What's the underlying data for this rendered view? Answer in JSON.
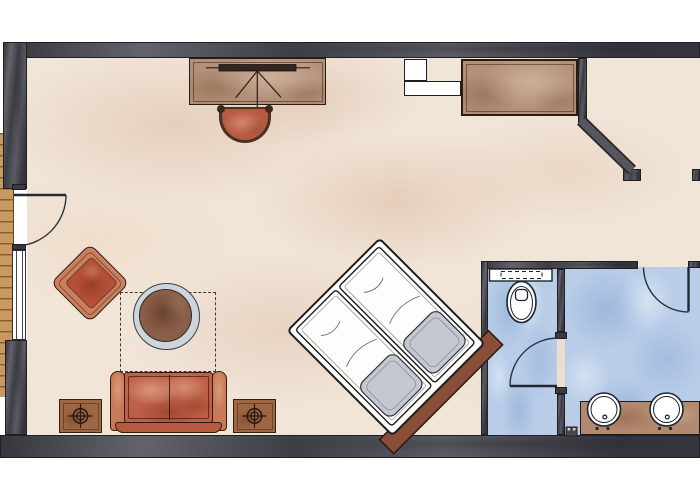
{
  "meta": {
    "kind": "hotel-room-floor-plan",
    "style": "hand-drawn-watercolor",
    "visible_text": []
  },
  "palette": {
    "background": "#ffffff",
    "wall": "#4d4d56",
    "wall_dark": "#33333b",
    "floor_beige": "#f1e5d8",
    "floor_blue": "#b9cde8",
    "wood_deck": "#c9995f",
    "furniture_brown": "#b3907a",
    "rust_red": "#bc6047",
    "rust_dark": "#9a4630",
    "outline": "#2a1c12",
    "bed_white": "#fdfdfc",
    "pillow_gray": "#c4c8d0",
    "headboard": "#8a4e38",
    "fixture_white": "#ffffff",
    "line_dark": "#1c2430",
    "counter": "#b28a70",
    "table_ring": "#ccd4dc",
    "table_top": "#8a5f4a",
    "tv_bar": "#332620"
  },
  "rooms": {
    "bedroom": {
      "floor": "beige-watercolor"
    },
    "entry": {
      "floor": "beige-watercolor"
    },
    "wc": {
      "floor": "blue-watercolor",
      "fixtures": [
        "toilet"
      ],
      "doors": 1
    },
    "bathroom": {
      "floor": "blue-watercolor",
      "fixtures": [
        "vanity-counter",
        "sink",
        "sink"
      ],
      "doors": 1
    }
  },
  "furniture": [
    "desk",
    "tv-on-desk",
    "desk-chair",
    "wardrobe",
    "luggage-rack",
    "armchair",
    "coffee-table",
    "rug-dashed-outline",
    "sofa",
    "side-table-with-lamp-left",
    "side-table-with-lamp-right",
    "double-bed-diagonal",
    "bed-headboard",
    "toilet",
    "vanity-counter",
    "sink-left",
    "sink-right",
    "bathroom-small-fixture"
  ],
  "openings": [
    "balcony-door-left-wall",
    "window-left-wall",
    "wc-door",
    "bathroom-door",
    "entry-opening-top-right"
  ],
  "counts": {
    "sinks": 2,
    "beds": 1,
    "door_swing_arcs": 3,
    "side_tables": 2
  }
}
